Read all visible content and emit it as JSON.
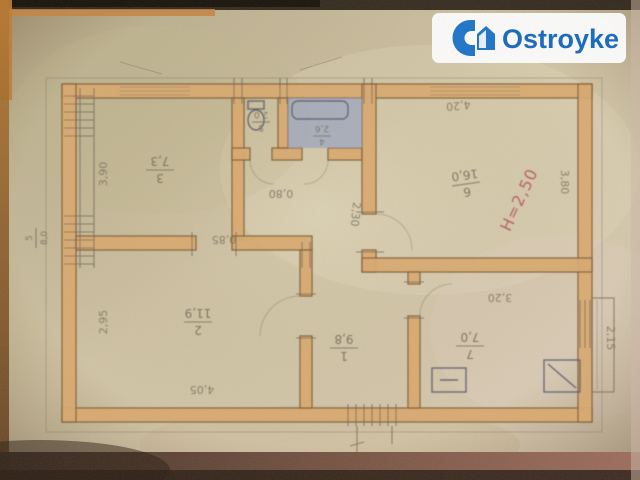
{
  "watermark": {
    "brand": "Ostroyke"
  },
  "plan": {
    "rooms": [
      {
        "number": "1",
        "area": "9,8",
        "name": "corridor"
      },
      {
        "number": "2",
        "area": "11,9",
        "name": "living-room"
      },
      {
        "number": "3",
        "area": "7,3",
        "name": "bedroom"
      },
      {
        "number": "4",
        "area": "2,6",
        "name": "bathroom"
      },
      {
        "number": "5",
        "area": "2,0",
        "name": "wc"
      },
      {
        "number": "6",
        "area": "16,0",
        "name": "main-room"
      },
      {
        "number": "7",
        "area": "7,0",
        "name": "kitchen"
      }
    ],
    "exterior_label": {
      "number": "5",
      "area": "8,0"
    },
    "dims": {
      "room3_left": "3,90",
      "room3_door": "0,85",
      "room2_left": "2,95",
      "room2_bottom": "4,05",
      "hall_door": "0,80",
      "hall_width": "2,30",
      "room6_top": "4,20",
      "room6_right": "3,80",
      "kitchen_top": "3,20",
      "kitchen_right": "2,15"
    },
    "ceiling_height": "Н=2,50",
    "symbols": [
      "toilet",
      "bathtub",
      "stove",
      "sink",
      "balcony"
    ]
  },
  "colors": {
    "brand_blue": "#1467bd",
    "height_note_red": "#b04458",
    "wall_fill": "#d9a96c",
    "bathroom_fill": "#97a2c0",
    "paper": "#cfc3a2"
  }
}
